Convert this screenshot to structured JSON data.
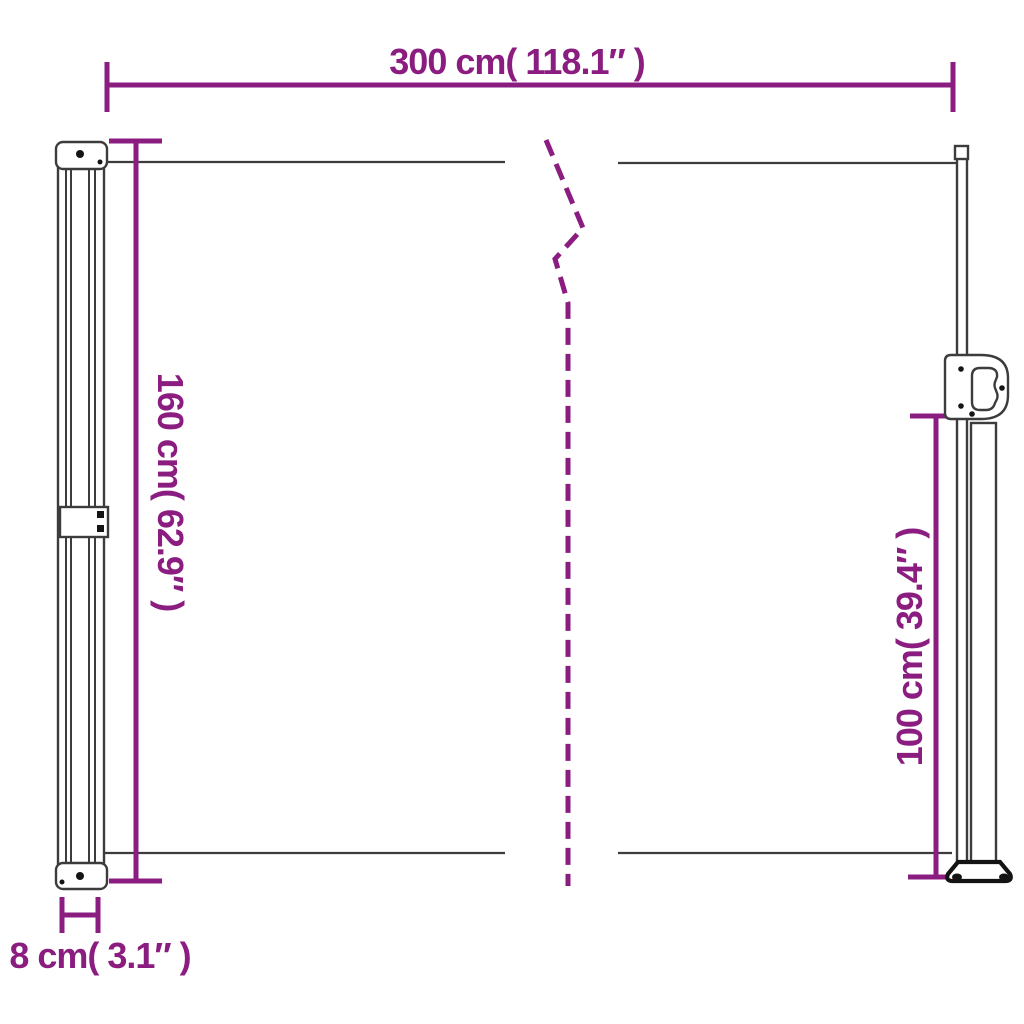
{
  "diagram": {
    "colors": {
      "dimension_accent": "#8B1D81",
      "outline_gray": "#3C3C3C",
      "hardware_black": "#141414"
    },
    "dimensions": {
      "total_width": "300 cm( 118.1″ )",
      "cassette_height": "160 cm( 62.9″ )",
      "pole_height": "100 cm( 39.4″ )",
      "cassette_depth": "8 cm( 3.1″ )"
    }
  }
}
